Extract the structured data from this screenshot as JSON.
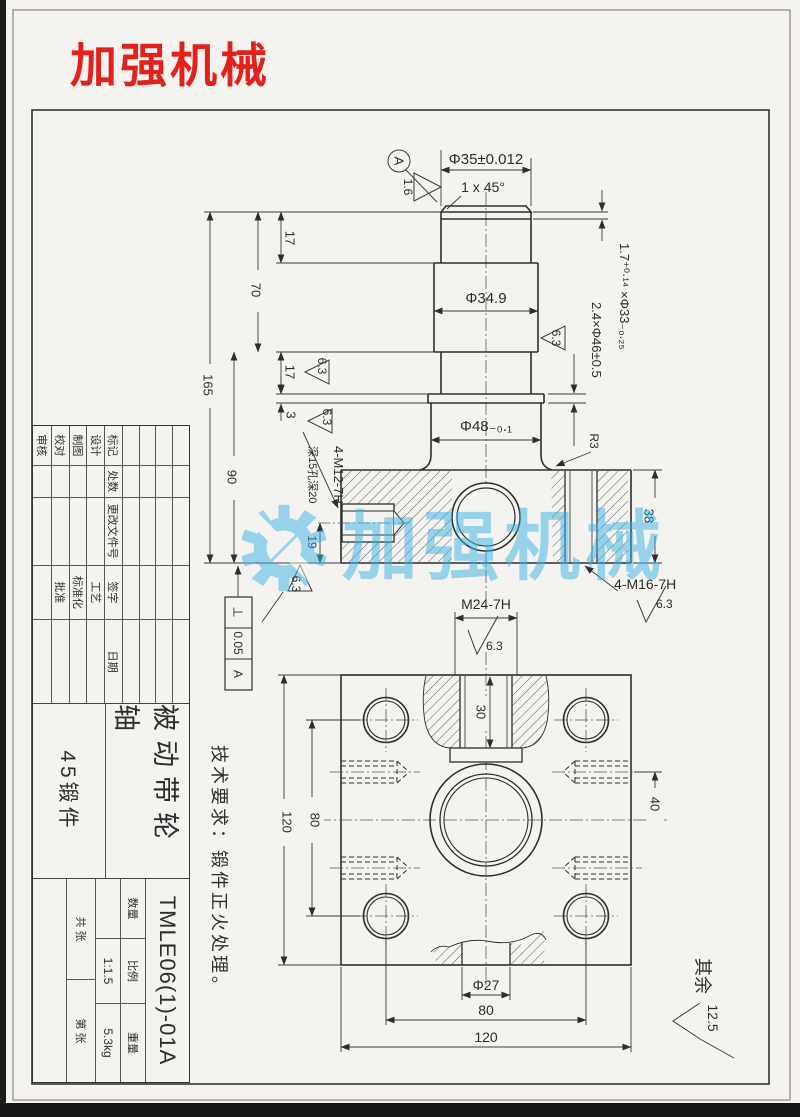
{
  "logo": {
    "text": "加强机械"
  },
  "watermark": {
    "text": "加强机械"
  },
  "colors": {
    "logo_red": "#e2201c",
    "watermark_blue": "#3ab5e8",
    "paper": "#f4f3ef",
    "line": "#2e2e2e"
  },
  "tech_requirements": "技术要求：锻件正火处理。",
  "surface_default": {
    "prefix": "其余",
    "value": "12.5"
  },
  "front_view": {
    "datum": "A",
    "dims": {
      "phi35": "Φ35±0.012",
      "chamfer": "1 x 45°",
      "groove_top": "1.7⁺⁰·¹⁴ ×Φ33₋₀.₂₅",
      "groove_mid": "2.4×Φ46±0.5",
      "phi349": "Φ34.9",
      "phi48": "Φ48₋₀.₁",
      "r3": "R3",
      "len165": "165",
      "len90": "90",
      "len70": "70",
      "len17a": "17",
      "len17b": "17",
      "len3": "3",
      "len19": "19",
      "len38": "38"
    },
    "threads": {
      "m12": "4-M12-7H",
      "m12_depth": "深15孔深20",
      "m16": "4-M16-7H",
      "m24": "M24-7H"
    },
    "tolerance_frame": {
      "symbol": "⊥",
      "value": "0.05",
      "datum": "A"
    },
    "finish": {
      "f16": "1.6",
      "f63": "6.3"
    }
  },
  "bottom_view": {
    "dims": {
      "d30": "30",
      "d40": "40",
      "d120_left": "120",
      "d80_left": "80",
      "phi27": "Φ27",
      "d80_bottom": "80",
      "d120_bottom": "120"
    }
  },
  "title_block": {
    "revision_header": [
      "标记",
      "处数",
      "更改文件号",
      "签字",
      "日期"
    ],
    "sign_rows": [
      {
        "label": "设计",
        "label2": "工艺"
      },
      {
        "label": "制图",
        "label2": "标准化"
      },
      {
        "label": "校对",
        "label2": "批准"
      },
      {
        "label": "审核",
        "label2": ""
      }
    ],
    "part_name": "被动带轮轴",
    "material": "45锻件",
    "drawing_no": "TMLE06(1)-01A",
    "labels": {
      "qty": "数量",
      "scale": "比例",
      "weight": "重量"
    },
    "values": {
      "scale": "1:1.5",
      "weight": "5.3kg"
    },
    "sheet": {
      "total": "共  张",
      "no": "第  张"
    }
  }
}
